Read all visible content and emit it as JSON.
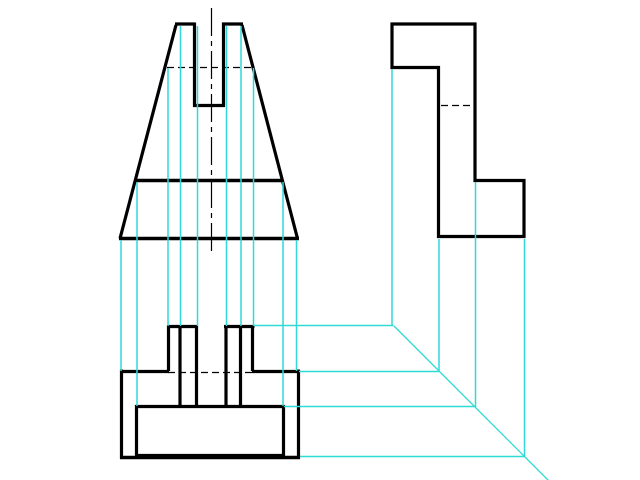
{
  "drawing": {
    "canvas": {
      "width": 640,
      "height": 480,
      "background": "#ffffff"
    },
    "strokes": {
      "outline": {
        "color": "#000000",
        "width": 3.2
      },
      "outline_heavy": {
        "color": "#000000",
        "width": 3.5
      },
      "hidden": {
        "color": "#000000",
        "width": 1.3,
        "dash": "7,4"
      },
      "center": {
        "color": "#000000",
        "width": 1.2,
        "dash": "28,5,5,5"
      },
      "projection": {
        "color": "#2ed9d6",
        "width": 1.5
      },
      "miter": {
        "color": "#2ed9d6",
        "width": 1.3
      }
    },
    "groups": {
      "front-view-outline": {
        "stroke": "outline",
        "segments": [
          {
            "name": "front-prong-top-left",
            "x1": 175,
            "y1": 24,
            "x2": 195,
            "y2": 24
          },
          {
            "name": "front-prong-top-right",
            "x1": 222,
            "y1": 24,
            "x2": 243,
            "y2": 24
          },
          {
            "name": "front-notch-wall-left",
            "x1": 194.5,
            "y1": 22.5,
            "x2": 194.5,
            "y2": 106.5
          },
          {
            "name": "front-notch-wall-right",
            "x1": 223.5,
            "y1": 22.5,
            "x2": 223.5,
            "y2": 106.5
          },
          {
            "name": "front-notch-bottom",
            "x1": 193,
            "y1": 105.5,
            "x2": 225,
            "y2": 105.5
          },
          {
            "name": "front-slope-left",
            "x1": 176,
            "y1": 25,
            "x2": 120,
            "y2": 238.5
          },
          {
            "name": "front-slope-right",
            "x1": 242,
            "y1": 25,
            "x2": 297.5,
            "y2": 238.5
          },
          {
            "name": "front-bottom-edge",
            "x1": 119,
            "y1": 238.5,
            "x2": 299,
            "y2": 238.5,
            "stroke": "outline_heavy"
          },
          {
            "name": "front-mid-edge",
            "x1": 135.5,
            "y1": 180.5,
            "x2": 283.5,
            "y2": 180.5,
            "stroke": "outline_heavy"
          }
        ]
      },
      "front-view-hidden": {
        "stroke": "hidden",
        "segments": [
          {
            "name": "front-hidden-slot-depth",
            "x1": 167,
            "y1": 67.5,
            "x2": 253,
            "y2": 67.5
          }
        ]
      },
      "front-view-centerline": {
        "stroke": "center",
        "segments": [
          {
            "name": "front-vertical-centerline",
            "x1": 211.5,
            "y1": 8,
            "x2": 211.5,
            "y2": 252
          }
        ]
      },
      "side-view-outline": {
        "stroke": "outline",
        "segments": [
          {
            "name": "side-top-edge",
            "x1": 390.5,
            "y1": 24,
            "x2": 476.5,
            "y2": 24
          },
          {
            "name": "side-left-edge",
            "x1": 392,
            "y1": 22.5,
            "x2": 392,
            "y2": 69
          },
          {
            "name": "side-step-horizontal",
            "x1": 390.5,
            "y1": 67.5,
            "x2": 440,
            "y2": 67.5
          },
          {
            "name": "side-step-vertical",
            "x1": 438.5,
            "y1": 66,
            "x2": 438.5,
            "y2": 238
          },
          {
            "name": "side-right-upper-edge",
            "x1": 475,
            "y1": 22.5,
            "x2": 475,
            "y2": 182
          },
          {
            "name": "side-foot-horizontal",
            "x1": 473.5,
            "y1": 180.5,
            "x2": 525.5,
            "y2": 180.5
          },
          {
            "name": "side-right-lower-edge",
            "x1": 524,
            "y1": 179,
            "x2": 524,
            "y2": 238
          },
          {
            "name": "side-bottom-edge",
            "x1": 437,
            "y1": 236.5,
            "x2": 525.5,
            "y2": 236.5
          }
        ]
      },
      "side-view-hidden": {
        "stroke": "hidden",
        "segments": [
          {
            "name": "side-hidden-notch-depth",
            "x1": 441,
            "y1": 105.5,
            "x2": 474,
            "y2": 105.5
          }
        ]
      },
      "top-view-outline": {
        "stroke": "outline",
        "segments": [
          {
            "name": "top-outer-left",
            "x1": 121.5,
            "y1": 369.5,
            "x2": 121.5,
            "y2": 459
          },
          {
            "name": "top-outer-right",
            "x1": 298.5,
            "y1": 369.5,
            "x2": 298.5,
            "y2": 459
          },
          {
            "name": "top-outer-top-left",
            "x1": 120,
            "y1": 371.5,
            "x2": 169,
            "y2": 371.5
          },
          {
            "name": "top-outer-top-right",
            "x1": 252,
            "y1": 371.5,
            "x2": 300,
            "y2": 371.5
          },
          {
            "name": "top-outer-bottom",
            "x1": 120,
            "y1": 457.5,
            "x2": 300,
            "y2": 457.5,
            "stroke": "outline_heavy"
          },
          {
            "name": "top-inner-left",
            "x1": 136.5,
            "y1": 405,
            "x2": 136.5,
            "y2": 457
          },
          {
            "name": "top-inner-right",
            "x1": 283.5,
            "y1": 405,
            "x2": 283.5,
            "y2": 457
          },
          {
            "name": "top-inner-top",
            "x1": 135,
            "y1": 406.5,
            "x2": 285,
            "y2": 406.5
          },
          {
            "name": "top-inner-bottom",
            "x1": 135,
            "y1": 455.5,
            "x2": 285,
            "y2": 455.5
          },
          {
            "name": "top-slot-left-top",
            "x1": 167,
            "y1": 326.5,
            "x2": 198,
            "y2": 326.5
          },
          {
            "name": "top-slot-left-outer",
            "x1": 168.5,
            "y1": 325,
            "x2": 168.5,
            "y2": 371
          },
          {
            "name": "top-slot-left-mid",
            "x1": 180,
            "y1": 325,
            "x2": 180,
            "y2": 408
          },
          {
            "name": "top-slot-left-inner",
            "x1": 196.5,
            "y1": 325,
            "x2": 196.5,
            "y2": 408
          },
          {
            "name": "top-slot-right-top",
            "x1": 224,
            "y1": 326.5,
            "x2": 254.5,
            "y2": 326.5
          },
          {
            "name": "top-slot-right-inner",
            "x1": 226,
            "y1": 325,
            "x2": 226,
            "y2": 408
          },
          {
            "name": "top-slot-right-mid",
            "x1": 240.5,
            "y1": 325,
            "x2": 240.5,
            "y2": 408
          },
          {
            "name": "top-slot-right-outer",
            "x1": 252.5,
            "y1": 325,
            "x2": 252.5,
            "y2": 371
          }
        ]
      },
      "top-view-hidden": {
        "stroke": "hidden",
        "segments": [
          {
            "name": "top-hidden-edge",
            "x1": 168,
            "y1": 372.5,
            "x2": 253,
            "y2": 372.5
          }
        ]
      },
      "projection-lines-front-to-top": {
        "stroke": "projection",
        "segments": [
          {
            "name": "proj-v-outer-left",
            "x1": 121,
            "y1": 240,
            "x2": 121,
            "y2": 371
          },
          {
            "name": "proj-v-mid-left",
            "x1": 137,
            "y1": 182,
            "x2": 137,
            "y2": 406
          },
          {
            "name": "proj-v-slot-l-outer",
            "x1": 168,
            "y1": 68,
            "x2": 168,
            "y2": 326
          },
          {
            "name": "proj-v-slot-l-mid",
            "x1": 180.5,
            "y1": 26,
            "x2": 180.5,
            "y2": 326
          },
          {
            "name": "proj-v-slot-l-inner",
            "x1": 197.5,
            "y1": 26,
            "x2": 197.5,
            "y2": 326
          },
          {
            "name": "proj-v-slot-r-inner",
            "x1": 226.5,
            "y1": 26,
            "x2": 226.5,
            "y2": 326
          },
          {
            "name": "proj-v-slot-r-mid",
            "x1": 241,
            "y1": 26,
            "x2": 241,
            "y2": 326
          },
          {
            "name": "proj-v-slot-r-outer",
            "x1": 253.5,
            "y1": 68,
            "x2": 253.5,
            "y2": 326
          },
          {
            "name": "proj-v-mid-right",
            "x1": 283,
            "y1": 182,
            "x2": 283,
            "y2": 406
          },
          {
            "name": "proj-v-outer-right",
            "x1": 296.5,
            "y1": 240,
            "x2": 296.5,
            "y2": 371
          }
        ]
      },
      "projection-lines-side-to-miter": {
        "stroke": "projection",
        "segments": [
          {
            "name": "proj-v-side-step",
            "x1": 392,
            "y1": 69,
            "x2": 392,
            "y2": 325.5
          },
          {
            "name": "proj-v-side-step-foot",
            "x1": 439,
            "y1": 239,
            "x2": 439,
            "y2": 371.5
          },
          {
            "name": "proj-v-side-right-up",
            "x1": 475.5,
            "y1": 182,
            "x2": 475.5,
            "y2": 407
          },
          {
            "name": "proj-v-side-right-low",
            "x1": 524.5,
            "y1": 239,
            "x2": 524.5,
            "y2": 456.5
          }
        ]
      },
      "projection-lines-top-to-miter": {
        "stroke": "projection",
        "segments": [
          {
            "name": "proj-h-slot-top-level",
            "x1": 254,
            "y1": 325.5,
            "x2": 393.5,
            "y2": 325.5
          },
          {
            "name": "proj-h-outer-top-level",
            "x1": 299,
            "y1": 371.5,
            "x2": 439,
            "y2": 371.5
          },
          {
            "name": "proj-h-inner-top-level",
            "x1": 284,
            "y1": 406.5,
            "x2": 475.5,
            "y2": 406.5
          },
          {
            "name": "proj-h-outer-bottom-level",
            "x1": 300,
            "y1": 456.5,
            "x2": 524.5,
            "y2": 456.5
          }
        ]
      },
      "miter-line": {
        "stroke": "miter",
        "segments": [
          {
            "name": "miter-45-line",
            "x1": 394,
            "y1": 326,
            "x2": 548.5,
            "y2": 480.5
          }
        ]
      }
    }
  }
}
